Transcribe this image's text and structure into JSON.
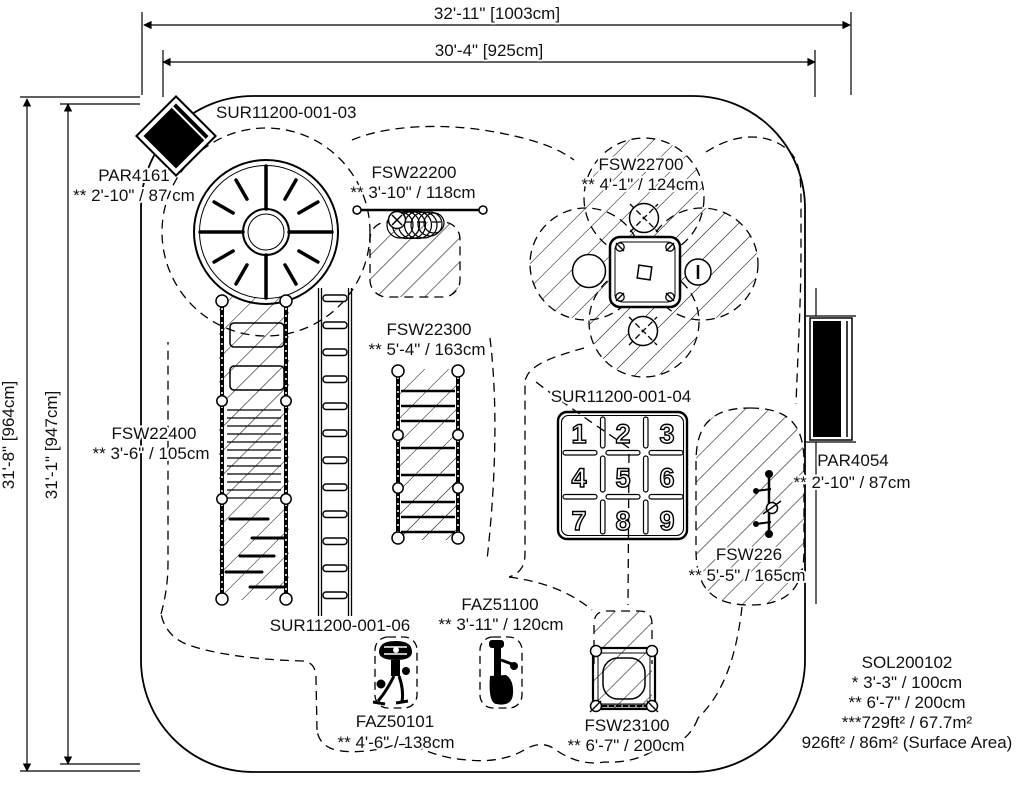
{
  "drawing": {
    "title": "playground-site-plan",
    "colors": {
      "ink": "#000000",
      "paper": "#ffffff"
    },
    "dims": {
      "top_outer": "32'-11\" [1003cm]",
      "top_inner": "30'-4\" [925cm]",
      "left_outer": "31'-8\" [964cm]",
      "left_inner": "31'-1\" [947cm]"
    },
    "items": {
      "par4161": {
        "name": "PAR4161",
        "dim": "** 2'-10\" / 87 cm"
      },
      "sur03": {
        "name": "SUR11200-001-03"
      },
      "fsw22200": {
        "name": "FSW22200",
        "dim": "** 3'-10\" / 118cm"
      },
      "fsw22700": {
        "name": "FSW22700",
        "dim": "** 4'-1\" / 124cm"
      },
      "fsw22300": {
        "name": "FSW22300",
        "dim": "** 5'-4\" / 163cm"
      },
      "fsw22400": {
        "name": "FSW22400",
        "dim": "** 3'-6\" / 105cm"
      },
      "sur04": {
        "name": "SUR11200-001-04"
      },
      "par4054": {
        "name": "PAR4054",
        "dim": "** 2'-10\" / 87cm"
      },
      "fsw226": {
        "name": "FSW226",
        "dim": "** 5'-5\" / 165cm"
      },
      "sur06": {
        "name": "SUR11200-001-06"
      },
      "faz51100": {
        "name": "FAZ51100",
        "dim": "** 3'-11\" / 120cm"
      },
      "faz50101": {
        "name": "FAZ50101",
        "dim": "** 4'-6\" / 138cm"
      },
      "fsw23100": {
        "name": "FSW23100",
        "dim": "** 6'-7\" / 200cm"
      }
    },
    "keypad": [
      "1",
      "2",
      "3",
      "4",
      "5",
      "6",
      "7",
      "8",
      "9"
    ],
    "summary": {
      "name": "SOL200102",
      "line1": "* 3'-3\" / 100cm",
      "line2": "** 6'-7\" / 200cm",
      "line3": "***729ft² / 67.7m²",
      "line4": "926ft² / 86m² (Surface Area)"
    }
  }
}
